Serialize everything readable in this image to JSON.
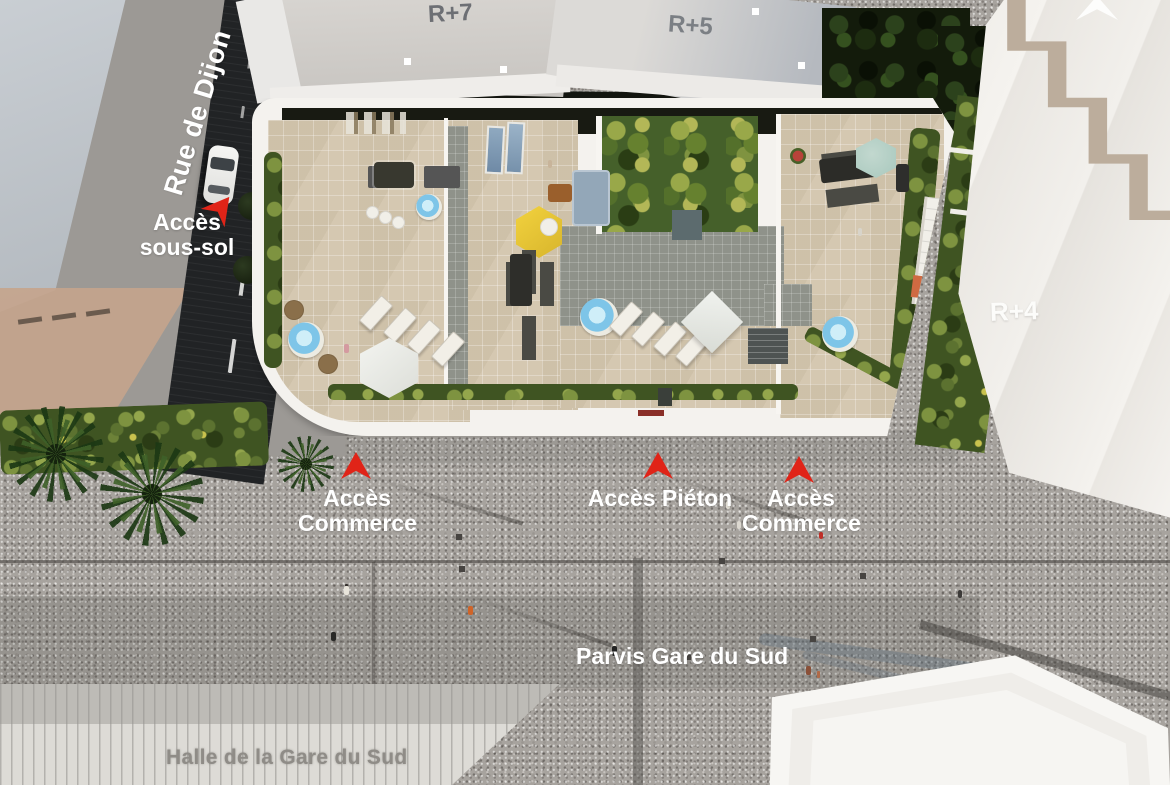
{
  "title": "Plan masse aérien — résidence Gare du Sud",
  "labels": {
    "r7": "R+7",
    "r5": "R+5",
    "r4": "R+4",
    "rue_de_dijon": "Rue de Dijon",
    "acces_sous_sol_1": "Accès",
    "acces_sous_sol_2": "sous-sol",
    "acces_commerce_left_1": "Accès",
    "acces_commerce_left_2": "Commerce",
    "acces_pieton": "Accès Piéton",
    "acces_commerce_right_1": "Accès",
    "acces_commerce_right_2": "Commerce",
    "parvis": "Parvis Gare du Sud",
    "halle": "Halle de la Gare du Sud"
  },
  "markers": {
    "count": 4,
    "type": "red-arrowhead",
    "items": [
      "acces-sous-sol",
      "acces-commerce-left",
      "acces-pieton",
      "acces-commerce-right"
    ]
  },
  "colors": {
    "marker_red": "#e02418",
    "road_asphalt": "#212325",
    "plaza_gray": "#a7a39e",
    "terrace_beige": "#d5c8b1",
    "garden_green": "#45602a",
    "pool_blue": "#7ec5e8",
    "umbrella_yellow": "#f2d23e",
    "umbrella_teal": "#a8c8bd",
    "facade_white": "#f4f2ee"
  }
}
